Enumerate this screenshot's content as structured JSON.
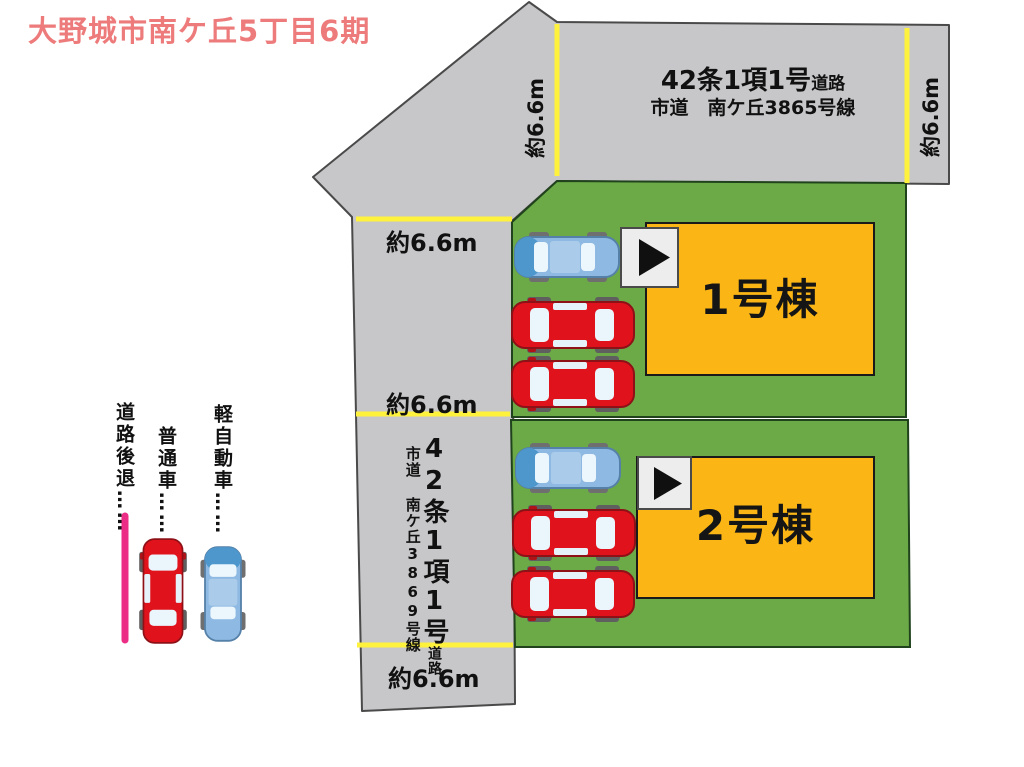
{
  "title": "大野城市南ケ丘5丁目6期",
  "top_road": {
    "regulation": "42条1項1号",
    "regulation_suffix": "道路",
    "street_name": "市道　南ケ丘3865号線",
    "width_label_left": "約6.6m",
    "width_label_right": "約6.6m"
  },
  "left_road": {
    "regulation": "42条1項1号",
    "regulation_suffix": "道路",
    "street_name": "市道 南ケ丘3869号線",
    "width_label_top": "約6.6m",
    "width_label_middle": "約6.6m",
    "width_label_bottom": "約6.6m"
  },
  "lots": [
    {
      "building_label": "1号棟"
    },
    {
      "building_label": "2号棟"
    }
  ],
  "legend": {
    "kei_car_label": "軽自動車……",
    "regular_car_label": "普通車……",
    "setback_label": "道路後退……"
  },
  "colors": {
    "road_gray": "#c7c7c9",
    "lot_green": "#6baa46",
    "building_gold": "#fbb616",
    "width_line_yellow": "#fff23c",
    "setback_pink": "#eb2d86",
    "regular_car_red": "#e0121c",
    "kei_car_blue": "#8db9e2",
    "title_pink": "#ee7b7b"
  }
}
